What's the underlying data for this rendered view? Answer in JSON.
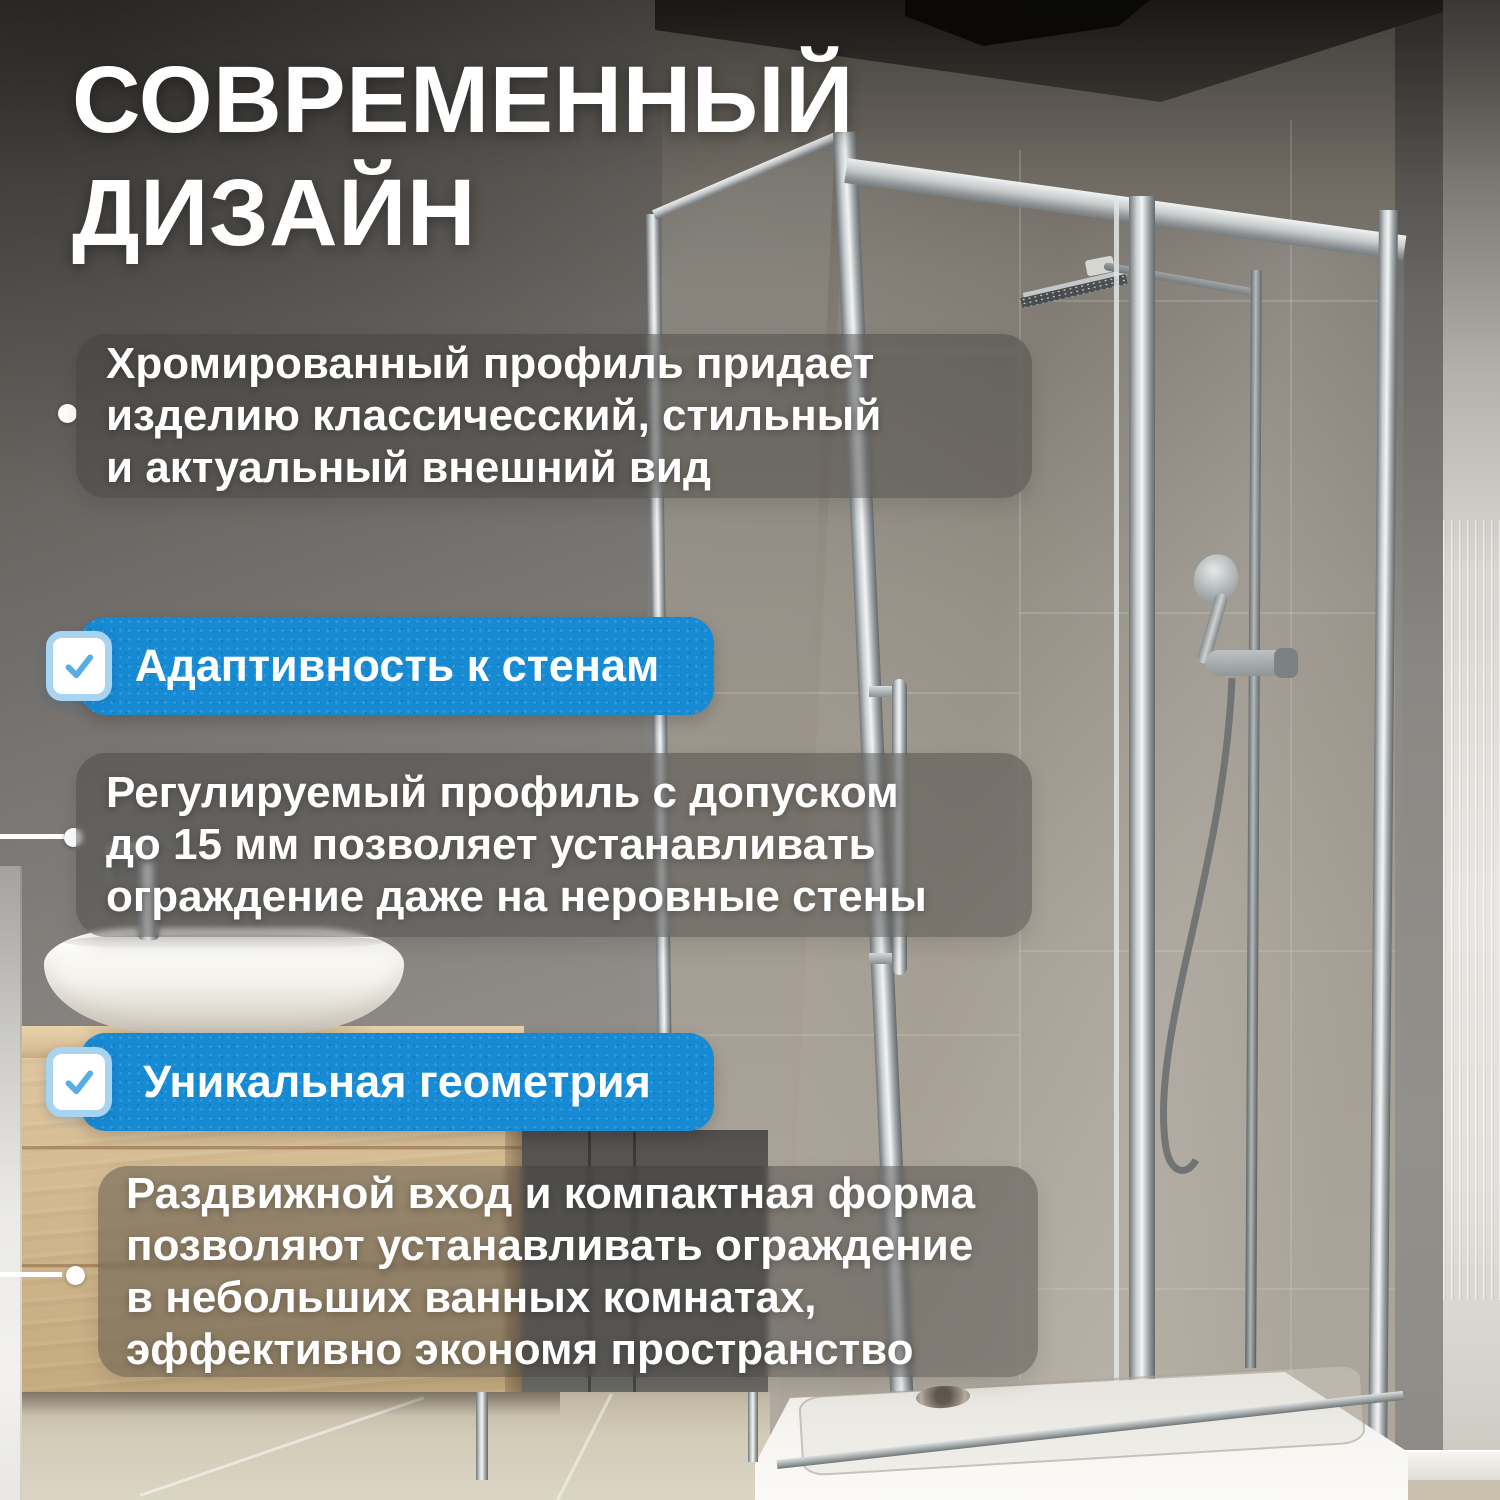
{
  "title": {
    "line1": "СОВРЕМЕННЫЙ",
    "line2": "ДИЗАЙН"
  },
  "blocks": [
    {
      "id": "chrome-profile",
      "lines": [
        "Хромированный профиль придает",
        "изделию классичесский, стильный",
        "и актуальный внешний вид"
      ]
    },
    {
      "id": "adjustable-profile",
      "lines": [
        "Регулируемый профиль с допуском",
        "до 15 мм позволяет устанавливать",
        "ограждение даже на неровные стены"
      ]
    },
    {
      "id": "compact-form",
      "lines": [
        "Раздвижной вход и компактная форма",
        "позволяют устанавливать ограждение",
        "в небольших ванных комнатах,",
        "эффективно экономя пространство"
      ]
    }
  ],
  "banners": [
    {
      "label": "Адаптивность к стенам",
      "icon": "checkbox-checked-icon"
    },
    {
      "label": "Уникальная геометрия",
      "icon": "checkbox-checked-icon"
    }
  ],
  "colors": {
    "banner_blue": "#178AD4",
    "checkbox_border": "#A8D3F1",
    "checkmark_blue": "#58ADE4",
    "text_white": "#FFFFFF",
    "overlay_gray": "rgba(62,60,58,0.42)"
  },
  "icons": {
    "banner_check": "checkbox-checked-icon",
    "bullet": "bullet-dot-icon",
    "callout": "callout-line-dot-icon"
  }
}
